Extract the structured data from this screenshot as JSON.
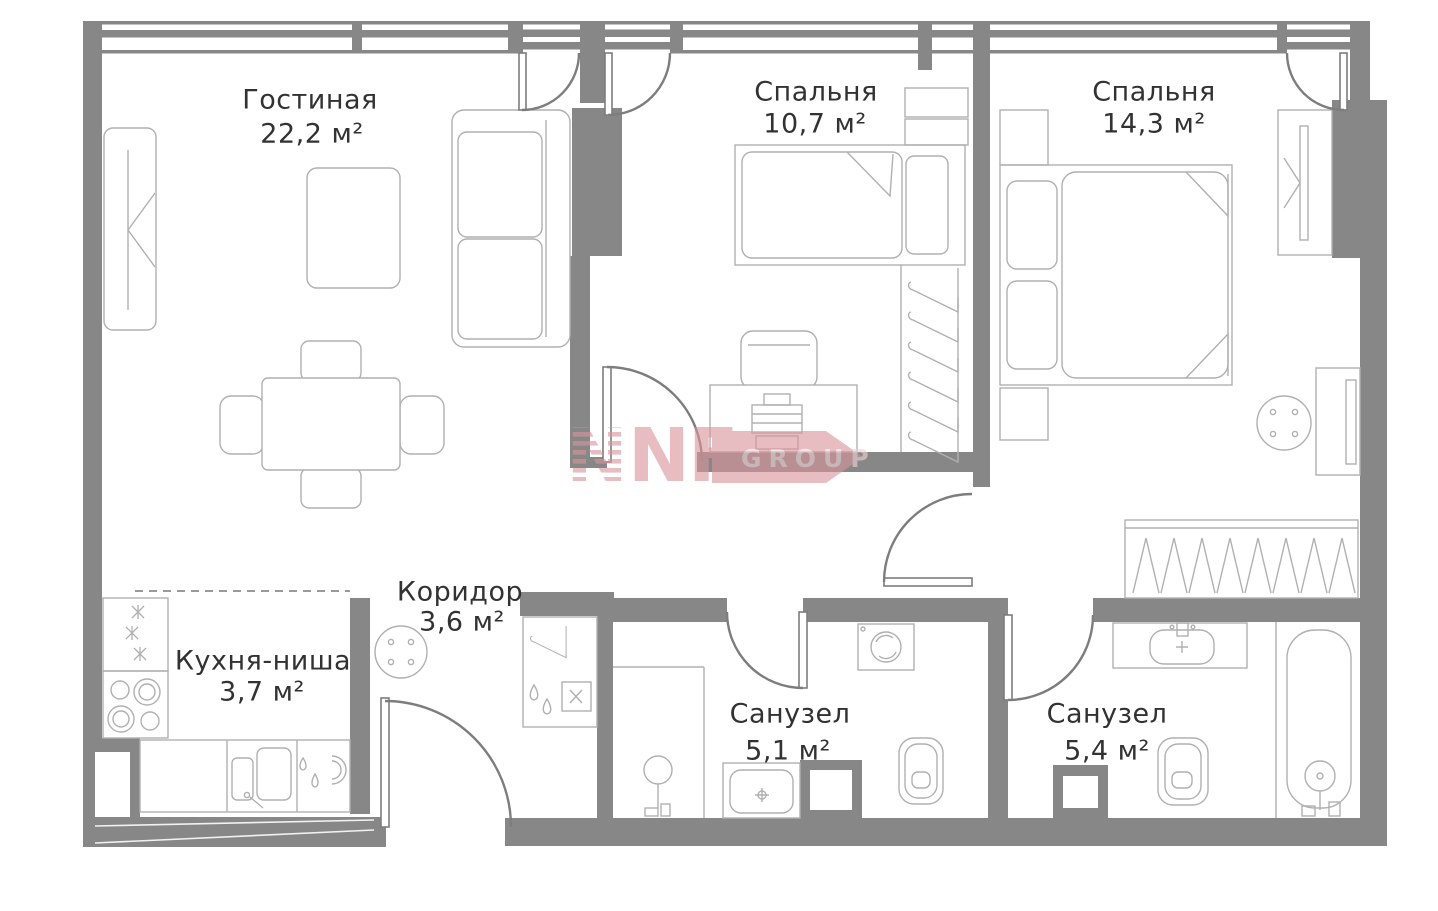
{
  "rooms": [
    {
      "id": "living",
      "name": "Гостиная",
      "area": "22,2 м²"
    },
    {
      "id": "bedroom1",
      "name": "Спальня",
      "area": "10,7 м²"
    },
    {
      "id": "bedroom2",
      "name": "Спальня",
      "area": "14,3 м²"
    },
    {
      "id": "kitchen",
      "name": "Кухня-ниша",
      "area": "3,7 м²"
    },
    {
      "id": "corridor",
      "name": "Коридор",
      "area": "3,6 м²"
    },
    {
      "id": "bath1",
      "name": "Санузел",
      "area": "5,1 м²"
    },
    {
      "id": "bath2",
      "name": "Санузел",
      "area": "5,4 м²"
    }
  ],
  "watermark": {
    "n_striped": "N",
    "n_solid": "N",
    "f_solid": "F",
    "banner_text": "GROUP"
  },
  "colors": {
    "wall": "#878787",
    "furniture_line": "#b0b0b0",
    "door_line": "#7d7d7d",
    "label": "#323232",
    "watermark_pink": "#d9959c",
    "watermark_text": "#eed3d5",
    "background": "#ffffff"
  }
}
